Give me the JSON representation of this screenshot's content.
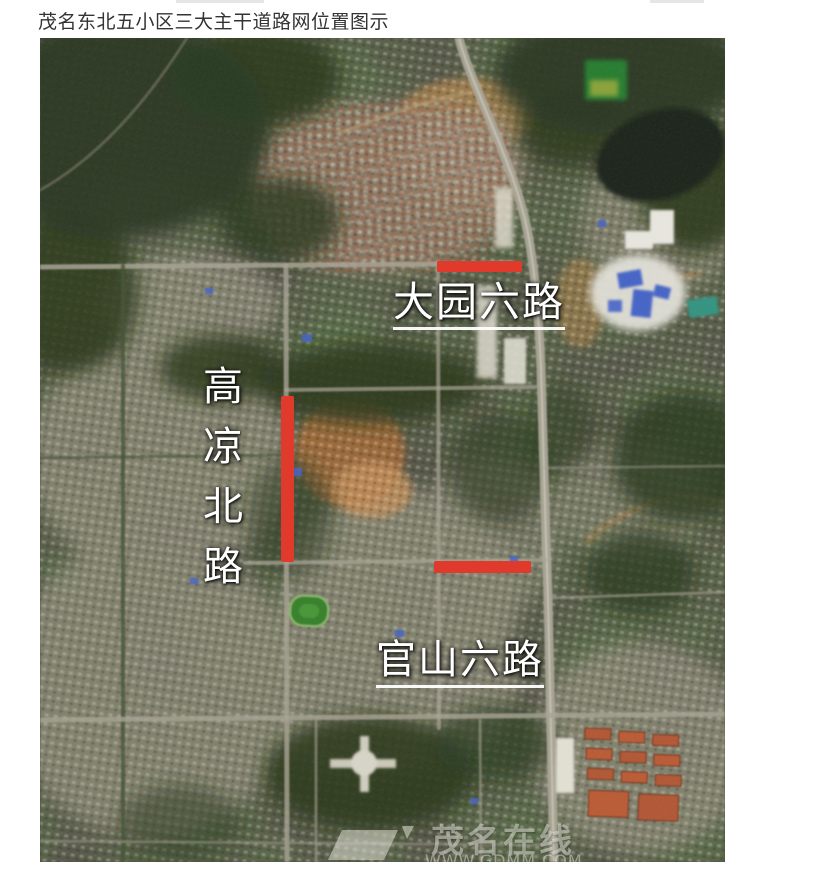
{
  "page": {
    "title": "茂名东北五小区三大主干道路网位置图示"
  },
  "map": {
    "type": "satellite-photo",
    "highlight_color": "#df3a2b",
    "roads": [
      {
        "name": "大园六路",
        "marker": "horizontal-red-bar",
        "label_style": "underlined"
      },
      {
        "name": "高凉北路",
        "marker": "vertical-red-bar",
        "label_style": "vertical"
      },
      {
        "name": "官山六路",
        "marker": "horizontal-red-bar",
        "label_style": "underlined"
      }
    ],
    "watermark": {
      "site": "茂名在线",
      "url": "WWW.GDMM.COM"
    }
  }
}
